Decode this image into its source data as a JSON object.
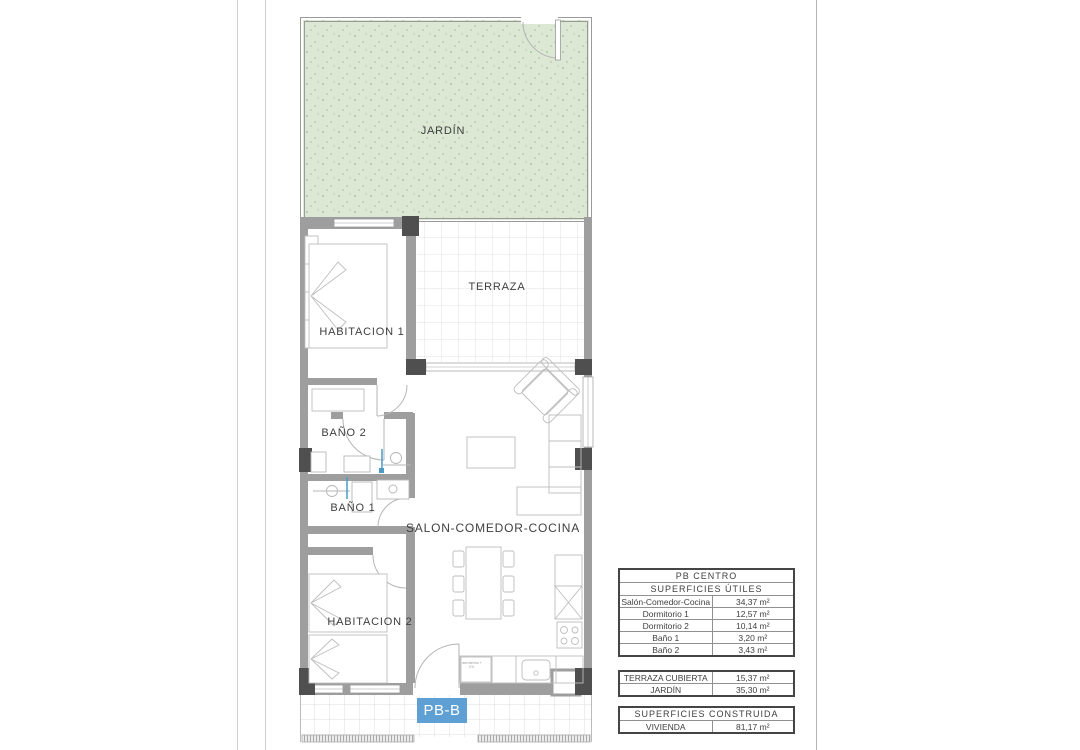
{
  "plan": {
    "rooms": {
      "jardin": "JARDÍN",
      "terraza": "TERRAZA",
      "habitacion1": "HABITACION 1",
      "bano2": "BAÑO 2",
      "bano1": "BAÑO 1",
      "salon": "SALON-COMEDOR-COCINA",
      "habitacion2": "HABITACION 2"
    },
    "floor_label": "PB-B",
    "kitchen_unit_note": "aerotermo + EV.",
    "icons": {
      "door-arc-icon": "quarter-circle door swing",
      "stairs-fan-icon": "bed pillow fan"
    },
    "colors": {
      "wall": "#9e9e9e",
      "pillar": "#4f4f4f",
      "garden_fill": "#dce8d3",
      "garden_dots": "#9cbb8e",
      "grid_line": "#e2e2e2",
      "furniture_line": "#bdbdbd",
      "plumbing_blue": "#4a9ac4",
      "badge_blue": "#5e9fd4",
      "text": "#3f3f3f"
    }
  },
  "tables": {
    "utiles": {
      "title": "PB CENTRO",
      "subtitle": "SUPERFICIES ÚTILES",
      "rows": [
        {
          "label": "Salón-Comedor-Cocina",
          "value": "34,37 m²"
        },
        {
          "label": "Dormitorio 1",
          "value": "12,57 m²"
        },
        {
          "label": "Dormitorio 2",
          "value": "10,14 m²"
        },
        {
          "label": "Baño 1",
          "value": "3,20 m²"
        },
        {
          "label": "Baño 2",
          "value": "3,43 m²"
        }
      ]
    },
    "exteriores": {
      "rows": [
        {
          "label": "TERRAZA CUBIERTA",
          "value": "15,37 m²"
        },
        {
          "label": "JARDÍN",
          "value": "35,30 m²"
        }
      ]
    },
    "construida": {
      "title": "SUPERFICIES CONSTRUIDA",
      "rows": [
        {
          "label": "VIVIENDA",
          "value": "81,17 m²"
        }
      ]
    }
  }
}
